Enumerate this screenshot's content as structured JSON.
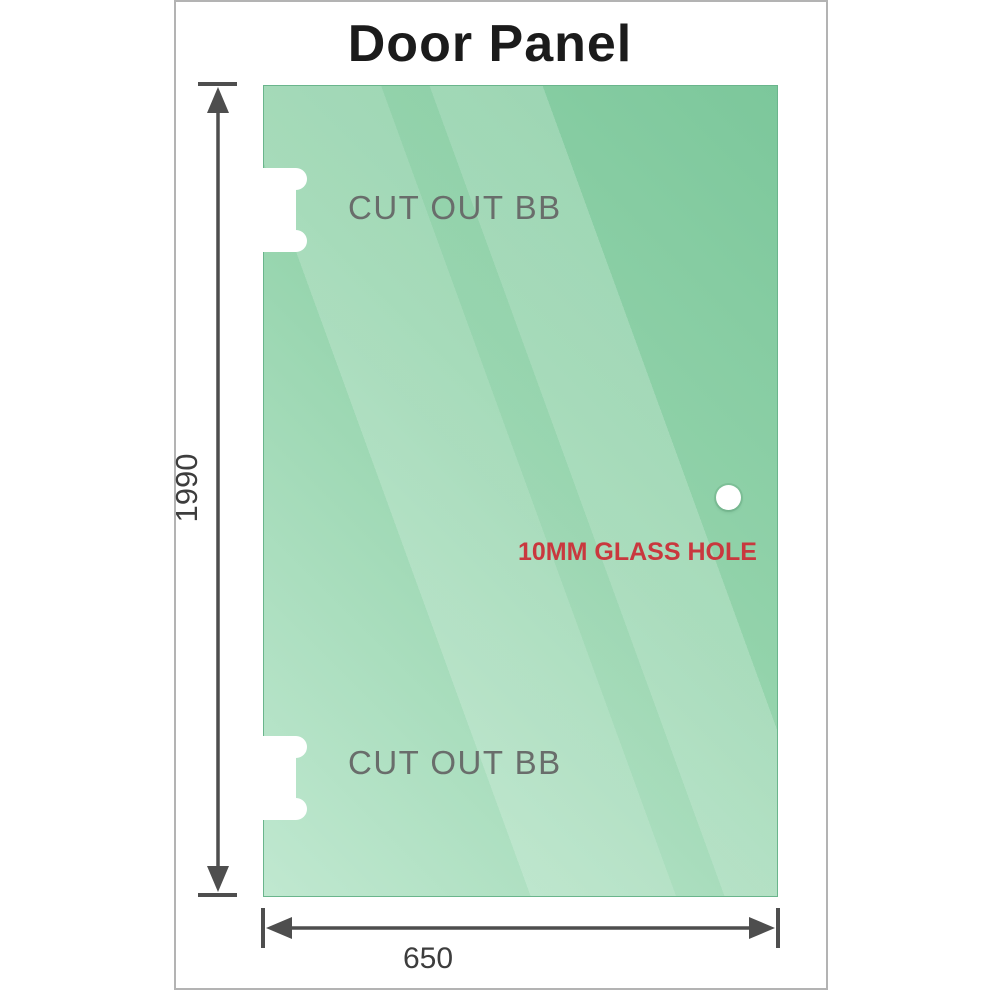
{
  "title": "Door Panel",
  "panel": {
    "cutouts": [
      {
        "label": "CUT OUT BB"
      },
      {
        "label": "CUT OUT BB"
      }
    ],
    "hole": {
      "label": "10MM GLASS HOLE"
    }
  },
  "dimensions": {
    "height_mm": "1990",
    "width_mm": "650"
  },
  "icons": {
    "glass_hole": "white-circle-hole",
    "hinge_cutout": "dog-bone-cutout"
  },
  "colors": {
    "glass_dark": "#7cc79b",
    "glass_light": "#c0e8d0",
    "glass_edge": "#6ab58c",
    "dimension_line": "#4e4e4e",
    "dim_text": "#3d3d3d",
    "hole_label_red": "#c9383e",
    "cutout_label_gray": "#696d6b",
    "title_color": "#1b1b1b",
    "frame_border": "#b3b3b3"
  }
}
